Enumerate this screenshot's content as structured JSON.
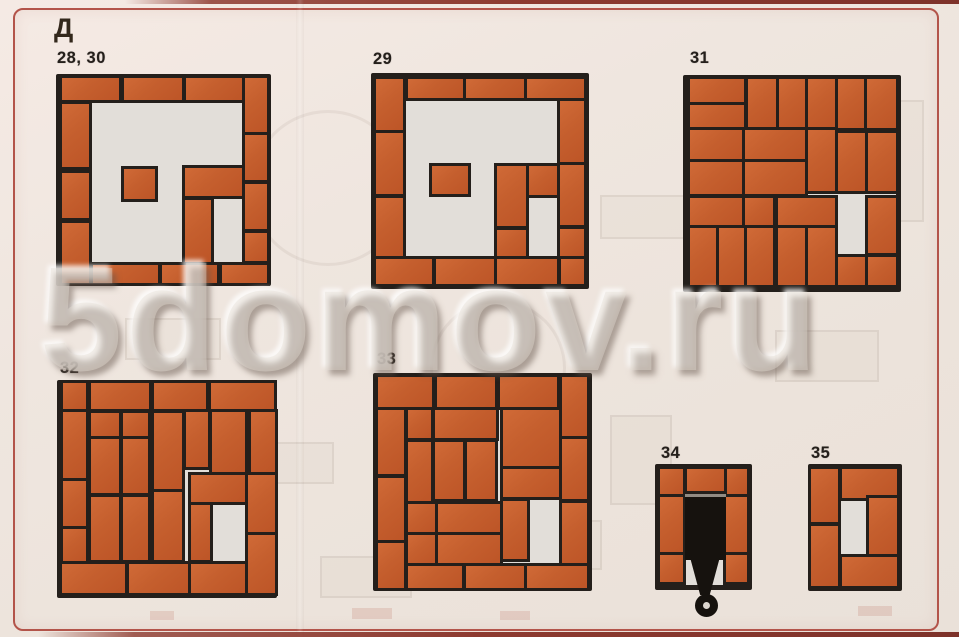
{
  "page": {
    "section_label": "Д",
    "watermark": "5domov.ru",
    "colors": {
      "brick": "#c55f2e",
      "mortar_line": "#241f1b",
      "paper": "#ece3db",
      "interior": "#e2ded9",
      "frame_border": "#b3544a",
      "edge_strip": "#8d3a30",
      "damper": "#16120e"
    }
  },
  "figures": [
    {
      "id": "28-30",
      "label": "28, 30",
      "label_x": 57,
      "label_y": 49,
      "x": 56,
      "y": 74,
      "w": 215,
      "h": 212,
      "bricks": [
        [
          3,
          2,
          26.5,
          10.5
        ],
        [
          31.5,
          2,
          27,
          10.5
        ],
        [
          60.5,
          2,
          26,
          10.5
        ],
        [
          88,
          2,
          10,
          25.5
        ],
        [
          88,
          29,
          10,
          21
        ],
        [
          88,
          52,
          10,
          21
        ],
        [
          88,
          75,
          10,
          13
        ],
        [
          3,
          14,
          12.2,
          30
        ],
        [
          3,
          46.5,
          12.2,
          21.5
        ],
        [
          3,
          70.5,
          12.2,
          28
        ],
        [
          17,
          90,
          30.5,
          8.5
        ],
        [
          49.5,
          90,
          25.5,
          8.5
        ],
        [
          77,
          90,
          21,
          8.5
        ],
        [
          31.5,
          45,
          14.5,
          14
        ],
        [
          60,
          44.5,
          26.5,
          13
        ],
        [
          60,
          59.5,
          12,
          29
        ]
      ]
    },
    {
      "id": "29",
      "label": "29",
      "label_x": 373,
      "label_y": 50,
      "x": 371,
      "y": 73,
      "w": 218,
      "h": 216,
      "bricks": [
        [
          2.3,
          3,
          12.2,
          23.5
        ],
        [
          16.8,
          3,
          25.2,
          8.5
        ],
        [
          43.5,
          3,
          26.8,
          8.5
        ],
        [
          71.7,
          3,
          25.8,
          8.5
        ],
        [
          86.5,
          13,
          11,
          28
        ],
        [
          86.5,
          42.5,
          11,
          28
        ],
        [
          86.5,
          72,
          11,
          12.5
        ],
        [
          2.3,
          28,
          12.2,
          28
        ],
        [
          2.3,
          58,
          12.2,
          26.5
        ],
        [
          2.3,
          86,
          25.9,
          11.5
        ],
        [
          29.8,
          86,
          26.7,
          11.5
        ],
        [
          58,
          86,
          27.5,
          11.5
        ],
        [
          87,
          86,
          10.8,
          11.5
        ],
        [
          28,
          43,
          16.3,
          13
        ],
        [
          58,
          43,
          13,
          28
        ],
        [
          58,
          72.5,
          13,
          12
        ],
        [
          72.5,
          43,
          13,
          13.5
        ]
      ]
    },
    {
      "id": "31",
      "label": "31",
      "label_x": 690,
      "label_y": 49,
      "x": 683,
      "y": 75,
      "w": 218,
      "h": 217,
      "bricks": [
        [
          3,
          2,
          25,
          11
        ],
        [
          3,
          14,
          25,
          10.5
        ],
        [
          30,
          2,
          12.5,
          22.5
        ],
        [
          44,
          2,
          12,
          22.5
        ],
        [
          57.5,
          2,
          12,
          22.5
        ],
        [
          71,
          2,
          12,
          22.5
        ],
        [
          84.5,
          2,
          13,
          22.5
        ],
        [
          3,
          25.5,
          25,
          13
        ],
        [
          28.5,
          25.5,
          27.5,
          13
        ],
        [
          57.5,
          25.5,
          12,
          28
        ],
        [
          71,
          26.5,
          12.5,
          27
        ],
        [
          85,
          26.5,
          12.5,
          27
        ],
        [
          3,
          40,
          25,
          15
        ],
        [
          28.5,
          40,
          27.5,
          15
        ],
        [
          3,
          56.5,
          25,
          12.5
        ],
        [
          28.5,
          56.5,
          13,
          12.5
        ],
        [
          43.5,
          56.5,
          26,
          12.5
        ],
        [
          85,
          56.5,
          12.5,
          25.5
        ],
        [
          3,
          70.5,
          12,
          26.5
        ],
        [
          16.5,
          70.5,
          11.5,
          26.5
        ],
        [
          29.5,
          70.5,
          12,
          26.5
        ],
        [
          43.5,
          70.5,
          12.5,
          26.5
        ],
        [
          57.5,
          70.5,
          12,
          26.5
        ],
        [
          71,
          84,
          12.5,
          13
        ],
        [
          85,
          84,
          12.5,
          13
        ]
      ]
    },
    {
      "id": "32",
      "label": "32",
      "label_x": 60,
      "label_y": 359,
      "x": 57,
      "y": 380,
      "w": 220,
      "h": 218,
      "bricks": [
        [
          2.6,
          1.5,
          10.6,
          12
        ],
        [
          15.5,
          1.5,
          26.5,
          12
        ],
        [
          44.2,
          1.5,
          23.5,
          12
        ],
        [
          70,
          1.5,
          28.5,
          12
        ],
        [
          2.6,
          14.5,
          10.6,
          30.5
        ],
        [
          2.6,
          46.5,
          10.6,
          20.5
        ],
        [
          2.6,
          68.5,
          10.6,
          14.5
        ],
        [
          15.5,
          15,
          12.5,
          10.5
        ],
        [
          30,
          15,
          11.5,
          10.5
        ],
        [
          44,
          15,
          13,
          35
        ],
        [
          58.5,
          14.5,
          10,
          25.5
        ],
        [
          70.5,
          14.5,
          15,
          27.5
        ],
        [
          88,
          14.5,
          11,
          27.5
        ],
        [
          15.5,
          27,
          12.5,
          25
        ],
        [
          30,
          27,
          11.5,
          25
        ],
        [
          15.5,
          53.5,
          12.5,
          29
        ],
        [
          30,
          53.5,
          11.5,
          29
        ],
        [
          44,
          51.5,
          13,
          31
        ],
        [
          61,
          43.5,
          24.5,
          12.5
        ],
        [
          61,
          57.5,
          8.5,
          25
        ],
        [
          87,
          43.5,
          12,
          26
        ],
        [
          87,
          71,
          12,
          26.5
        ],
        [
          2.3,
          84.5,
          28.7,
          13
        ],
        [
          32.5,
          84.5,
          27,
          13
        ],
        [
          61,
          84.5,
          24.5,
          13
        ]
      ]
    },
    {
      "id": "33",
      "label": "33",
      "label_x": 377,
      "label_y": 350,
      "x": 373,
      "y": 373,
      "w": 219,
      "h": 218,
      "bricks": [
        [
          2.3,
          2,
          24.5,
          13.5
        ],
        [
          29,
          2,
          26.5,
          13.5
        ],
        [
          58,
          2,
          26,
          13.5
        ],
        [
          86.3,
          2,
          11.4,
          27
        ],
        [
          2.3,
          17,
          12,
          29.5
        ],
        [
          2.3,
          48,
          12,
          28.5
        ],
        [
          2.3,
          78,
          12,
          20.5
        ],
        [
          15.8,
          17,
          10.8,
          13
        ],
        [
          15.8,
          31.5,
          10.8,
          27
        ],
        [
          28.3,
          17,
          27.7,
          13
        ],
        [
          59.5,
          17,
          25.3,
          25.5
        ],
        [
          86.3,
          30.5,
          11.4,
          27.5
        ],
        [
          86.3,
          59.5,
          11.4,
          27.5
        ],
        [
          28.3,
          31.5,
          13,
          26.5
        ],
        [
          42.8,
          31.5,
          13,
          26.5
        ],
        [
          59.5,
          44,
          25.3,
          13
        ],
        [
          15.8,
          60,
          12.5,
          13
        ],
        [
          29.8,
          60,
          28,
          13
        ],
        [
          59.5,
          58.5,
          11,
          27
        ],
        [
          15.8,
          74.5,
          12.5,
          12.5
        ],
        [
          29.8,
          74.5,
          28,
          12.5
        ],
        [
          15.8,
          88.5,
          25,
          10
        ],
        [
          42.3,
          88.5,
          26.5,
          10
        ],
        [
          70.3,
          88.5,
          27.5,
          10
        ]
      ]
    },
    {
      "id": "34",
      "label": "34",
      "label_x": 661,
      "label_y": 444,
      "x": 655,
      "y": 464,
      "w": 97,
      "h": 126,
      "bricks": [
        [
          5,
          4,
          24,
          20
        ],
        [
          5,
          26.5,
          24,
          44
        ],
        [
          5,
          72.5,
          24,
          21.5
        ],
        [
          73.5,
          4,
          21.5,
          20
        ],
        [
          73.5,
          26.5,
          21.5,
          44
        ],
        [
          73.5,
          72.5,
          21.5,
          21.5
        ],
        [
          32.5,
          4,
          38.5,
          17.5
        ]
      ],
      "damper": {
        "plate": [
          30.5,
          23.5,
          43,
          50.5
        ],
        "handle": [
          34,
          71,
          35,
          33
        ],
        "ring": {
          "cx_pct": 53,
          "cy_px": 141,
          "r_px": 11.5
        }
      }
    },
    {
      "id": "35",
      "label": "35",
      "label_x": 811,
      "label_y": 444,
      "x": 808,
      "y": 464,
      "w": 94,
      "h": 127,
      "bricks": [
        [
          3.6,
          4,
          28.5,
          42
        ],
        [
          3.6,
          48.5,
          28.5,
          47.5
        ],
        [
          35.7,
          4,
          59,
          22.5
        ],
        [
          64.5,
          26.5,
          30,
          44.5
        ],
        [
          35.7,
          73,
          59,
          23
        ]
      ]
    }
  ],
  "ghosts": [
    {
      "type": "circle",
      "x": 250,
      "y": 110,
      "w": 150,
      "h": 150
    },
    {
      "type": "circle",
      "x": 430,
      "y": 300,
      "w": 130,
      "h": 130
    },
    {
      "type": "rect",
      "x": 600,
      "y": 195,
      "w": 120,
      "h": 40
    },
    {
      "type": "rect",
      "x": 775,
      "y": 330,
      "w": 100,
      "h": 48
    },
    {
      "type": "rect",
      "x": 125,
      "y": 318,
      "w": 92,
      "h": 38
    },
    {
      "type": "rect",
      "x": 480,
      "y": 520,
      "w": 118,
      "h": 46
    },
    {
      "type": "rect",
      "x": 250,
      "y": 442,
      "w": 80,
      "h": 38
    },
    {
      "type": "rect",
      "x": 872,
      "y": 100,
      "w": 48,
      "h": 118
    },
    {
      "type": "rect",
      "x": 610,
      "y": 415,
      "w": 58,
      "h": 86
    },
    {
      "type": "rect",
      "x": 320,
      "y": 556,
      "w": 88,
      "h": 38
    },
    {
      "type": "redbit",
      "x": 352,
      "y": 608,
      "w": 40,
      "h": 11
    },
    {
      "type": "redbit",
      "x": 500,
      "y": 611,
      "w": 30,
      "h": 9
    },
    {
      "type": "redbit",
      "x": 150,
      "y": 611,
      "w": 24,
      "h": 9
    },
    {
      "type": "redbit",
      "x": 858,
      "y": 606,
      "w": 34,
      "h": 10
    }
  ]
}
